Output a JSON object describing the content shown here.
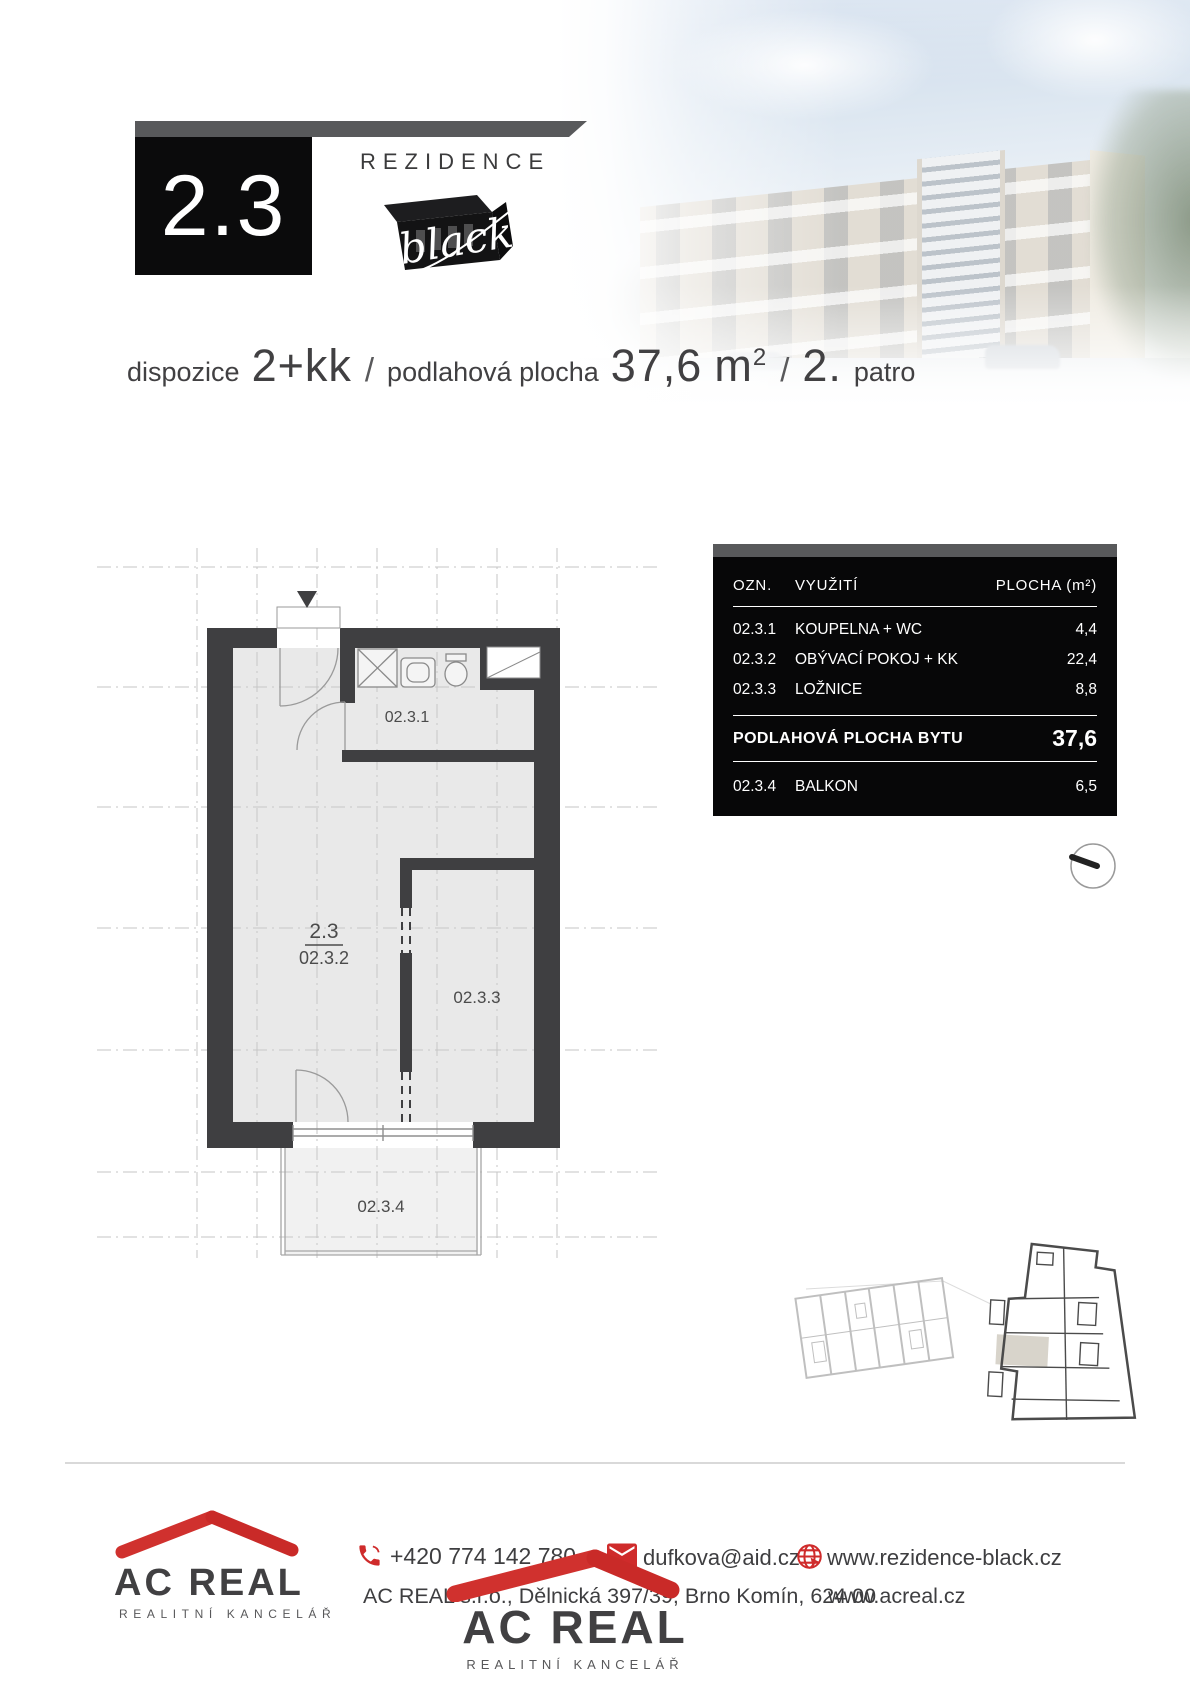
{
  "header": {
    "unit_number": "2.3",
    "brand_name": "REZIDENCE",
    "brand_script": "black"
  },
  "summary": {
    "disp_label": "dispozice",
    "disp_value": "2+kk",
    "sep": "/",
    "area_label": "podlahová plocha",
    "area_value": "37,6",
    "area_unit": "m",
    "area_sup": "2",
    "floor_value": "2.",
    "floor_label": "patro"
  },
  "table": {
    "header": {
      "ozn": "OZN.",
      "use": "VYUŽITÍ",
      "area": "PLOCHA (m²)"
    },
    "rows": [
      {
        "ozn": "02.3.1",
        "use": "KOUPELNA + WC",
        "area": "4,4"
      },
      {
        "ozn": "02.3.2",
        "use": "OBÝVACÍ POKOJ + KK",
        "area": "22,4"
      },
      {
        "ozn": "02.3.3",
        "use": "LOŽNICE",
        "area": "8,8"
      }
    ],
    "total": {
      "label": "PODLAHOVÁ PLOCHA BYTU",
      "area": "37,6"
    },
    "extra": {
      "ozn": "02.3.4",
      "use": "BALKON",
      "area": "6,5"
    }
  },
  "plan": {
    "unit_label": "2.3",
    "rooms": {
      "bathroom": "02.3.1",
      "living": "02.3.2",
      "bedroom": "02.3.3",
      "balcony": "02.3.4"
    }
  },
  "footer": {
    "logo_name": "AC REAL",
    "logo_subtitle": "REALITNÍ KANCELÁŘ",
    "phone": "+420 774 142 780",
    "email": "dufkova@aid.cz",
    "website_project": "www.rezidence-black.cz",
    "website_company": "www.acreal.cz",
    "address": "AC REAL s.r.o., Dělnická 397/39, Brno Komín, 624 00"
  },
  "colors": {
    "accent_red": "#cf2b2b",
    "bar_grey": "#58595b",
    "wall_dark": "#3f3f41"
  }
}
